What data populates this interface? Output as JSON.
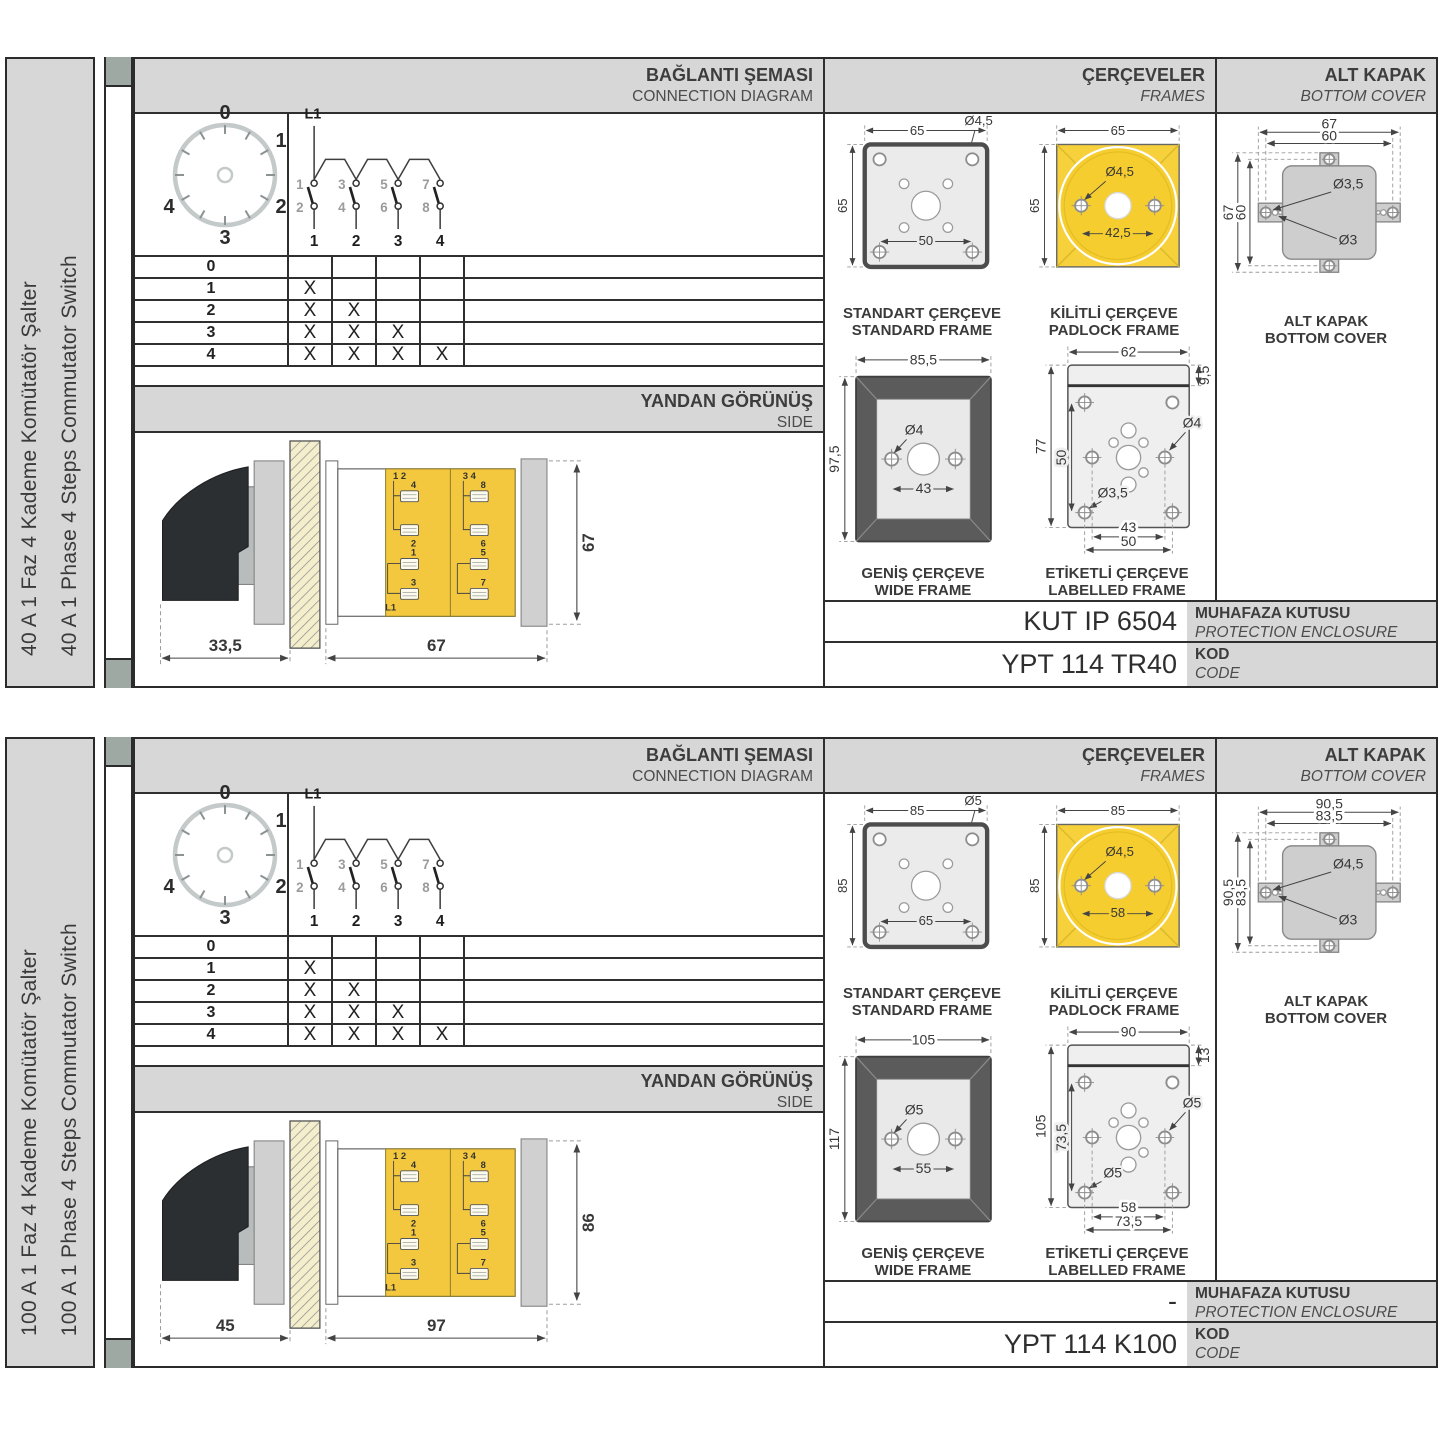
{
  "sections": [
    {
      "sidebar_tr": "40 A 1 Faz 4 Kademe Komütatör Şalter",
      "sidebar_en": "40 A 1 Phase 4 Steps Commutator Switch",
      "conn": {
        "title_tr": "BAĞLANTI ŞEMASI",
        "title_en": "CONNECTION DIAGRAM",
        "dial": [
          "0",
          "1",
          "2",
          "3",
          "4"
        ],
        "phase": "L1",
        "top_contacts": [
          "1",
          "3",
          "5",
          "7"
        ],
        "bottom_contacts": [
          "2",
          "4",
          "6",
          "8"
        ],
        "poles": [
          "1",
          "2",
          "3",
          "4"
        ],
        "rows": [
          {
            "step": "0",
            "marks": [
              "",
              "",
              "",
              ""
            ]
          },
          {
            "step": "1",
            "marks": [
              "X",
              "",
              "",
              ""
            ]
          },
          {
            "step": "2",
            "marks": [
              "X",
              "X",
              "",
              ""
            ]
          },
          {
            "step": "3",
            "marks": [
              "X",
              "X",
              "X",
              ""
            ]
          },
          {
            "step": "4",
            "marks": [
              "X",
              "X",
              "X",
              "X"
            ]
          }
        ]
      },
      "side": {
        "title_tr": "YANDAN GÖRÜNÜŞ",
        "title_en": "SIDE",
        "dim_front": "33,5",
        "dim_body": "67",
        "dim_height": "67",
        "pairs": [
          "1 2",
          "3 4"
        ],
        "terms": [
          "4",
          "2",
          "1",
          "3",
          "8",
          "6",
          "5",
          "7"
        ],
        "phase": "L1"
      },
      "frames": {
        "title_tr": "ÇERÇEVELER",
        "title_en": "FRAMES",
        "standard": {
          "tr": "STANDART ÇERÇEVE",
          "en": "STANDARD FRAME",
          "w": "65",
          "h": "65",
          "hole": "Ø4,5",
          "pitch": "50"
        },
        "padlock": {
          "tr": "KİLİTLİ ÇERÇEVE",
          "en": "PADLOCK FRAME",
          "w": "65",
          "h": "65",
          "hole": "Ø4,5",
          "pitch": "42,5"
        },
        "wide": {
          "tr": "GENİŞ ÇERÇEVE",
          "en": "WIDE FRAME",
          "w": "85,5",
          "h": "97,5",
          "hole": "Ø4",
          "pitch": "43"
        },
        "labelled": {
          "tr": "ETİKETLİ ÇERÇEVE",
          "en": "LABELLED FRAME",
          "w": "62",
          "strip": "9,5",
          "h": "77",
          "vpitch": "50",
          "hole_side": "Ø4",
          "hole_corner": "Ø3,5",
          "pitch_a": "43",
          "pitch_b": "50"
        }
      },
      "cover": {
        "title_tr": "ALT KAPAK",
        "title_en": "BOTTOM COVER",
        "caption_tr": "ALT KAPAK",
        "caption_en": "BOTTOM COVER",
        "w_outer": "67",
        "w_inner": "60",
        "h_outer": "67",
        "h_inner": "60",
        "hole_tab": "Ø3,5",
        "hole_small": "Ø3"
      },
      "enclosure": {
        "value": "KUT IP 6504",
        "label_tr": "MUHAFAZA KUTUSU",
        "label_en": "PROTECTION ENCLOSURE"
      },
      "code": {
        "value": "YPT 114 TR40",
        "label_tr": "KOD",
        "label_en": "CODE"
      }
    },
    {
      "sidebar_tr": "100 A 1 Faz 4 Kademe Komütatör Şalter",
      "sidebar_en": "100 A 1 Phase 4 Steps Commutator Switch",
      "conn": {
        "title_tr": "BAĞLANTI ŞEMASI",
        "title_en": "CONNECTION DIAGRAM",
        "dial": [
          "0",
          "1",
          "2",
          "3",
          "4"
        ],
        "phase": "L1",
        "top_contacts": [
          "1",
          "3",
          "5",
          "7"
        ],
        "bottom_contacts": [
          "2",
          "4",
          "6",
          "8"
        ],
        "poles": [
          "1",
          "2",
          "3",
          "4"
        ],
        "rows": [
          {
            "step": "0",
            "marks": [
              "",
              "",
              "",
              ""
            ]
          },
          {
            "step": "1",
            "marks": [
              "X",
              "",
              "",
              ""
            ]
          },
          {
            "step": "2",
            "marks": [
              "X",
              "X",
              "",
              ""
            ]
          },
          {
            "step": "3",
            "marks": [
              "X",
              "X",
              "X",
              ""
            ]
          },
          {
            "step": "4",
            "marks": [
              "X",
              "X",
              "X",
              "X"
            ]
          }
        ]
      },
      "side": {
        "title_tr": "YANDAN GÖRÜNÜŞ",
        "title_en": "SIDE",
        "dim_front": "45",
        "dim_body": "97",
        "dim_height": "86",
        "pairs": [
          "1 2",
          "3 4"
        ],
        "terms": [
          "4",
          "2",
          "1",
          "3",
          "8",
          "6",
          "5",
          "7"
        ],
        "phase": "L1"
      },
      "frames": {
        "title_tr": "ÇERÇEVELER",
        "title_en": "FRAMES",
        "standard": {
          "tr": "STANDART ÇERÇEVE",
          "en": "STANDARD FRAME",
          "w": "85",
          "h": "85",
          "hole": "Ø5",
          "pitch": "65"
        },
        "padlock": {
          "tr": "KİLİTLİ ÇERÇEVE",
          "en": "PADLOCK FRAME",
          "w": "85",
          "h": "85",
          "hole": "Ø4,5",
          "pitch": "58"
        },
        "wide": {
          "tr": "GENİŞ ÇERÇEVE",
          "en": "WIDE FRAME",
          "w": "105",
          "h": "117",
          "hole": "Ø5",
          "pitch": "55"
        },
        "labelled": {
          "tr": "ETİKETLİ ÇERÇEVE",
          "en": "LABELLED FRAME",
          "w": "90",
          "strip": "13",
          "h": "105",
          "vpitch": "73,5",
          "hole_side": "Ø5",
          "hole_corner": "Ø5",
          "pitch_a": "58",
          "pitch_b": "73,5"
        }
      },
      "cover": {
        "title_tr": "ALT KAPAK",
        "title_en": "BOTTOM COVER",
        "caption_tr": "ALT KAPAK",
        "caption_en": "BOTTOM COVER",
        "w_outer": "90,5",
        "w_inner": "83,5",
        "h_outer": "90,5",
        "h_inner": "83,5",
        "hole_tab": "Ø4,5",
        "hole_small": "Ø3"
      },
      "enclosure": {
        "value": "-",
        "label_tr": "MUHAFAZA KUTUSU",
        "label_en": "PROTECTION ENCLOSURE"
      },
      "code": {
        "value": "YPT 114 K100",
        "label_tr": "KOD",
        "label_en": "CODE"
      }
    }
  ]
}
